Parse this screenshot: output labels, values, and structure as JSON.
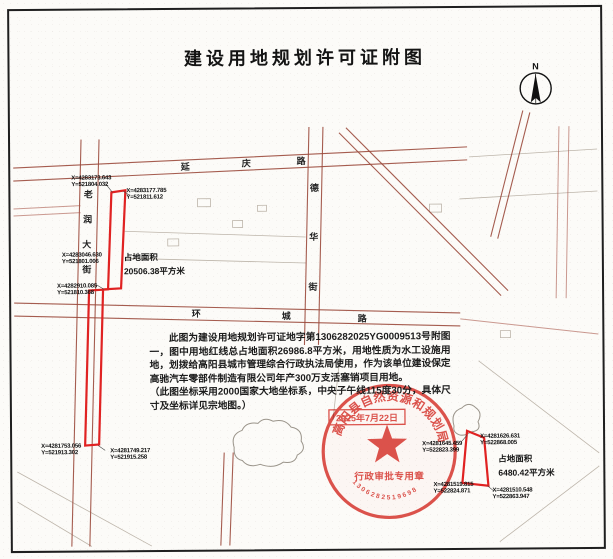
{
  "title": "建设用地规划许可证附图",
  "compass": {
    "label": "N"
  },
  "streets": {
    "yanqing": {
      "name": "延庆路",
      "chars": [
        "延",
        "庆",
        "路"
      ]
    },
    "laorun": {
      "name": "老润大街",
      "chars": [
        "老",
        "润",
        "大",
        "街"
      ]
    },
    "dehua": {
      "name": "德华街",
      "chars": [
        "德",
        "华",
        "街"
      ]
    },
    "huancheng": {
      "name": "环城路",
      "chars": [
        "环",
        "城",
        "路"
      ]
    }
  },
  "parcels": {
    "west": {
      "area_title": "占地面积",
      "area_value": "20506.38平方米",
      "coords": [
        {
          "x": "X=4283173.643",
          "y": "Y=521804.032"
        },
        {
          "x": "X=4283177.785",
          "y": "Y=521811.612"
        },
        {
          "x": "X=4283046.630",
          "y": "Y=521801.006"
        },
        {
          "x": "X=4282910.085",
          "y": "Y=521810.368"
        },
        {
          "x": "X=4281753.056",
          "y": "Y=521913.302"
        },
        {
          "x": "X=4281749.217",
          "y": "Y=521915.258"
        }
      ]
    },
    "east": {
      "area_title": "占地面积",
      "area_value": "6480.42平方米",
      "coords": [
        {
          "x": "X=4281645.459",
          "y": "Y=522823.399"
        },
        {
          "x": "X=4281626.631",
          "y": "Y=522868.005"
        },
        {
          "x": "X=4281519.815",
          "y": "Y=522824.871"
        },
        {
          "x": "X=4281510.548",
          "y": "Y=522863.947"
        }
      ]
    }
  },
  "notes": {
    "para1": "此图为建设用地规划许可证地字第1306282025YG0009513号附图一，图中用地红线总占地面积26986.8平方米，用地性质为水工设施用地，划拨给高阳县城市管理综合行政执法局使用，作为该单位建设保定高驰汽车零部件制造有限公司年产300万支活塞销项目用地。",
    "para2": "（此图坐标采用2000国家大地坐标系，中央子午线115度30分，具体尺寸及坐标详见宗地图。）"
  },
  "seal": {
    "org": "高阳县自然资源和规划局",
    "center_text": "行政审批专用章",
    "serial": "1306282519698",
    "date": "2025年7月22日"
  },
  "colors": {
    "parcel_red": "#e02222",
    "seal_red": "#d63831",
    "road_brown": "#9b4a3c",
    "paper": "#fcfbf8"
  }
}
